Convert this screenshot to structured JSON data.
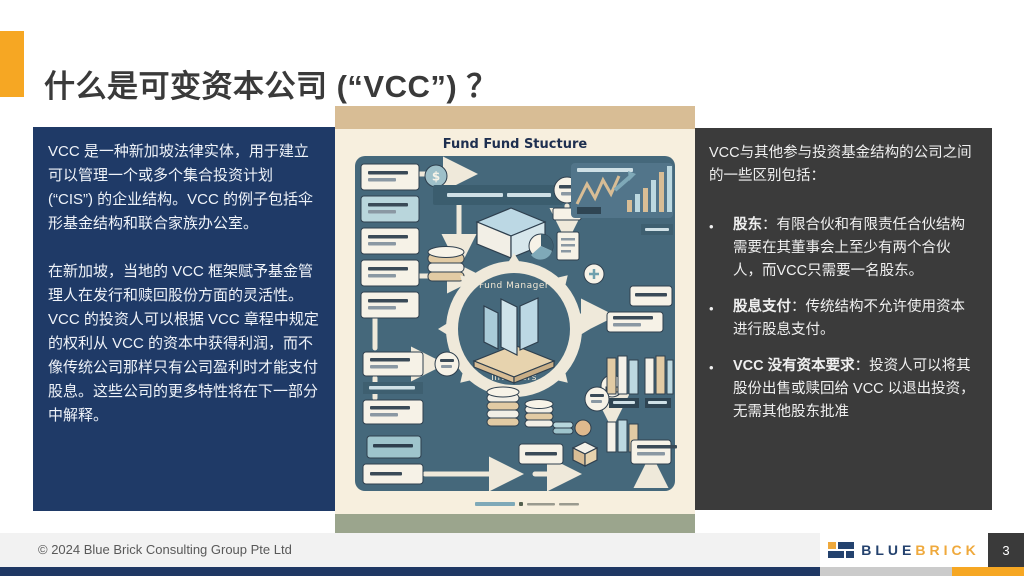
{
  "slide": {
    "title": "什么是可变资本公司 (“VCC”) ？"
  },
  "left_panel": {
    "paragraph1": "VCC 是一种新加坡法律实体，用于建立可以管理一个或多个集合投资计划 (“CIS”) 的企业结构。VCC 的例子包括伞形基金结构和联合家族办公室。",
    "paragraph2": "在新加坡，当地的 VCC 框架赋予基金管理人在发行和赎回股份方面的灵活性。 VCC 的投资人可以根据 VCC 章程中规定的权利从 VCC 的资本中获得利润，而不像传统公司那样只有公司盈利时才能支付股息。这些公司的更多特性将在下一部分中解释。"
  },
  "right_panel": {
    "intro": "VCC与其他参与投资基金结构的公司之间的一些区别包括：",
    "bullet_glyph": "•",
    "bullets": [
      {
        "lead": "股东",
        "text": "：有限合伙和有限责任合伙结构需要在其董事会上至少有两个合伙人，而VCC只需要一名股东。"
      },
      {
        "lead": "股息支付",
        "text": "：传统结构不允许使用资本进行股息支付。"
      },
      {
        "lead": "VCC 没有资本要求",
        "text": "：投资人可以将其股份出售或赎回给 VCC 以退出投资，无需其他股东批准"
      }
    ]
  },
  "illustration": {
    "title": "Fund Fund Stucture",
    "hub_top_label": "Fund Manager",
    "hub_bottom_label": "Investors",
    "dollar_sign": "$"
  },
  "footer": {
    "copyright": "© 2024 Blue Brick Consulting Group Pte Ltd",
    "logo_blue": "BLUE",
    "logo_brick": "BRICK",
    "page_number": "3"
  },
  "colors": {
    "accent_orange": "#F6A723",
    "panel_navy": "#1F3A67",
    "panel_gray": "#3B3B3B",
    "bottom_bar_navy": "#1F3864",
    "illustration_cream": "#F7EFDE",
    "illustration_tan": "#D8BD95",
    "illustration_green": "#9BA58D",
    "illustration_teal": "#45687B",
    "logo_navy": "#24426E",
    "logo_orange": "#EFA93C"
  }
}
